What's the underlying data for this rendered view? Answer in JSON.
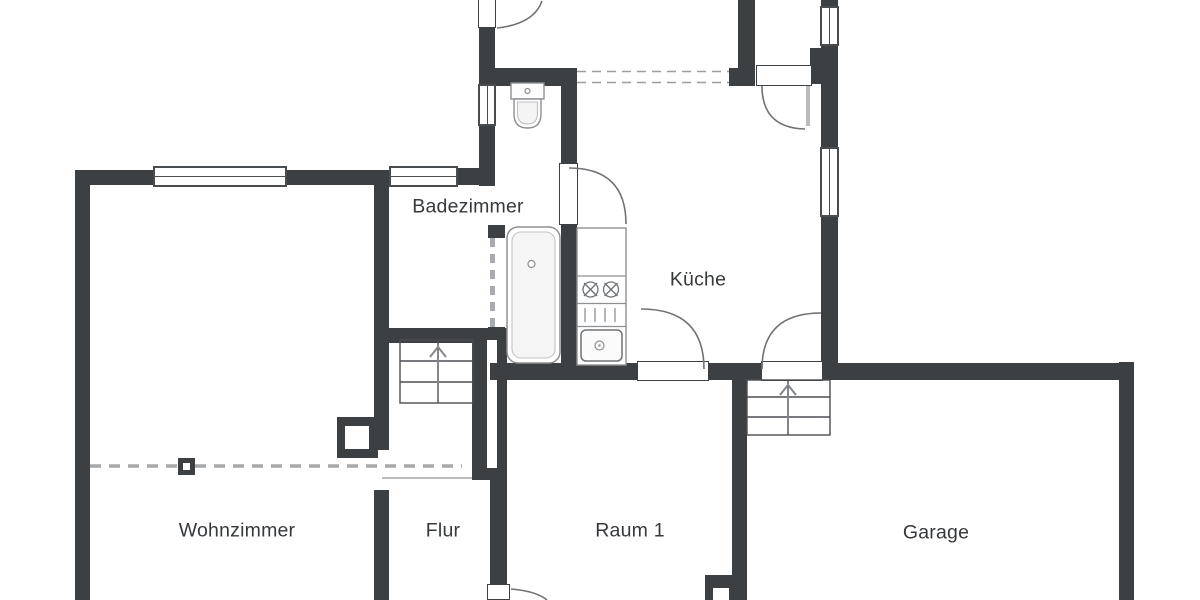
{
  "floorplan": {
    "type": "floor-plan-drawing",
    "background_color": "#ffffff",
    "wall_color": "#3d4043",
    "line_color": "#6f7276",
    "rooms": [
      {
        "id": "badezimmer",
        "label": "Badezimmer"
      },
      {
        "id": "kueche",
        "label": "Küche"
      },
      {
        "id": "wohnzimmer",
        "label": "Wohnzimmer"
      },
      {
        "id": "flur",
        "label": "Flur"
      },
      {
        "id": "raum1",
        "label": "Raum 1"
      },
      {
        "id": "garage",
        "label": "Garage"
      }
    ],
    "fixtures": [
      {
        "name": "toilet"
      },
      {
        "name": "bathtub"
      },
      {
        "name": "kitchen-counter"
      },
      {
        "name": "stove-burners"
      },
      {
        "name": "kitchen-sink"
      },
      {
        "name": "staircase-flur"
      },
      {
        "name": "staircase-garage"
      },
      {
        "name": "chimney-block"
      },
      {
        "name": "support-column"
      }
    ]
  }
}
